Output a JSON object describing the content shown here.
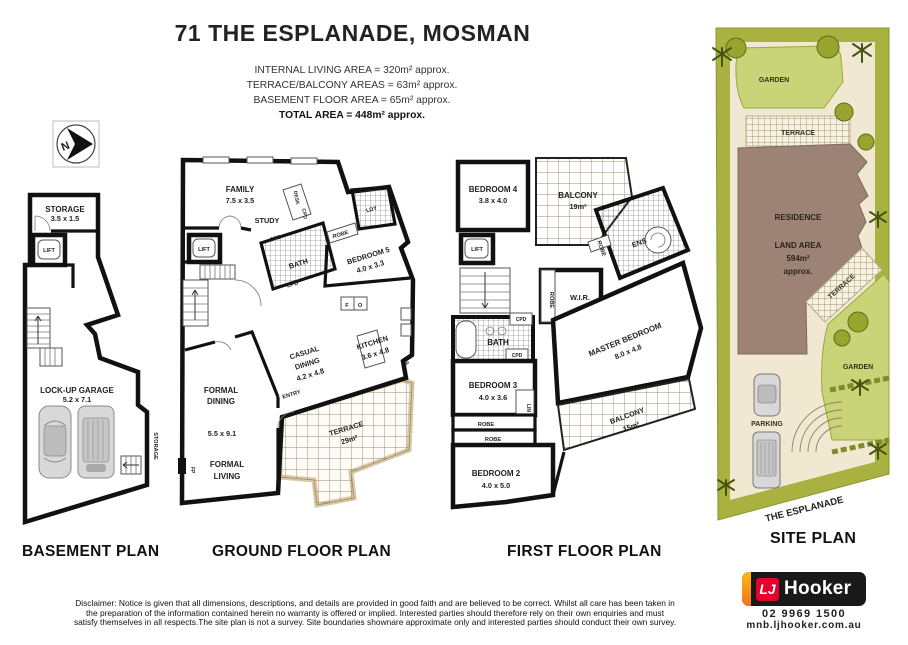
{
  "header": {
    "title": "71 THE ESPLANADE, MOSMAN",
    "area_lines": [
      "INTERNAL LIVING AREA = 320m² approx.",
      "TERRACE/BALCONY AREAS = 63m² approx.",
      "BASEMENT FLOOR AREA = 65m² approx.",
      "TOTAL AREA = 448m² approx."
    ]
  },
  "north": {
    "letter": "N"
  },
  "basement": {
    "label": "BASEMENT PLAN",
    "storage": "STORAGE",
    "storage_dims": "3.5 x 1.5",
    "lift": "LIFT",
    "garage": "LOCK-UP GARAGE",
    "garage_dims": "5.2 x 7.1",
    "storage_side": "STORAGE"
  },
  "ground": {
    "label": "GROUND FLOOR PLAN",
    "family": "FAMILY",
    "family_dims": "7.5 x 3.5",
    "study": "STUDY",
    "desk": "DESK",
    "cpd_a": "CPD",
    "cpd_b": "CPD",
    "cpd_c": "CPD",
    "ldy": "LDY",
    "robe": "ROBE",
    "bedroom5": "BEDROOM 5",
    "bedroom5_dims": "4.0 x 3.3",
    "bath": "BATH",
    "lift": "LIFT",
    "f": "F",
    "o": "O",
    "p": "P",
    "fp": "FP",
    "casual_line1": "CASUAL",
    "casual_line2": "DINING",
    "casual_dims": "4.2 x 4.8",
    "kitchen": "KITCHEN",
    "kitchen_dims": "3.6 x 4.8",
    "formal_dining_line1": "FORMAL",
    "formal_dining_line2": "DINING",
    "formal_dining_dims": "5.5 x 9.1",
    "entry": "ENTRY",
    "terrace": "TERRACE",
    "terrace_area": "29m²",
    "formal_living_line1": "FORMAL",
    "formal_living_line2": "LIVING"
  },
  "first": {
    "label": "FIRST FLOOR PLAN",
    "bedroom4": "BEDROOM 4",
    "bedroom4_dims": "3.8 x 4.0",
    "balcony_top": "BALCONY",
    "balcony_top_area": "19m²",
    "lift": "LIFT",
    "robe_a": "ROBE",
    "robe_b": "ROBE",
    "robe_c": "ROBE",
    "robe_d": "ROBE",
    "wir": "W.I.R.",
    "ens": "ENS",
    "bath": "BATH",
    "cpd_a": "CPD",
    "cpd_b": "CPD",
    "bedroom3": "BEDROOM 3",
    "bedroom3_dims": "4.0 x 3.6",
    "lin": "LIN",
    "bedroom2": "BEDROOM 2",
    "bedroom2_dims": "4.0 x 5.0",
    "master": "MASTER BEDROOM",
    "master_dims": "8.0 x 4.8",
    "balcony_low": "BALCONY",
    "balcony_low_area": "15m²"
  },
  "site": {
    "label": "SITE PLAN",
    "garden_top": "GARDEN",
    "terrace_top": "TERRACE",
    "residence": "RESIDENCE",
    "land_area_line1": "LAND AREA",
    "land_area_line2": "594m²",
    "land_area_line3": "approx.",
    "terrace_mid": "TERRACE",
    "garden_right": "GARDEN",
    "parking": "PARKING",
    "street": "THE ESPLANADE"
  },
  "footer": {
    "logo_lj": "LJ",
    "logo_name": "Hooker",
    "phone": "02 9969 1500",
    "website": "mnb.ljhooker.com.au",
    "disclaimer_lines": [
      "Disclaimer: Notice is given that all dimensions, descriptions, and details are provided in good faith and are believed to be correct. Whilst all care has been taken in",
      "the preparation of the information contained herein no warranty is offered or implied. Interested parties should therefore rely on their own enquiries and must",
      "satisfy themselves in all respects.The site plan is not a survey. Site boundaries shownare approximate only and interested parties should conduct their own survey."
    ]
  },
  "colors": {
    "wall": "#111111",
    "terrace_border": "#d9c8a3",
    "tile_line": "#9c8a66",
    "site_olive": "#a9b240",
    "site_lawn": "#c9d377",
    "site_cream": "#f0e8d0",
    "site_residence": "#9c8375",
    "site_tree_dark": "#465311",
    "logo_red": "#e4002b",
    "logo_yellow": "#fdb913",
    "logo_orange": "#f37021",
    "text_dark": "#1a1a1a"
  }
}
